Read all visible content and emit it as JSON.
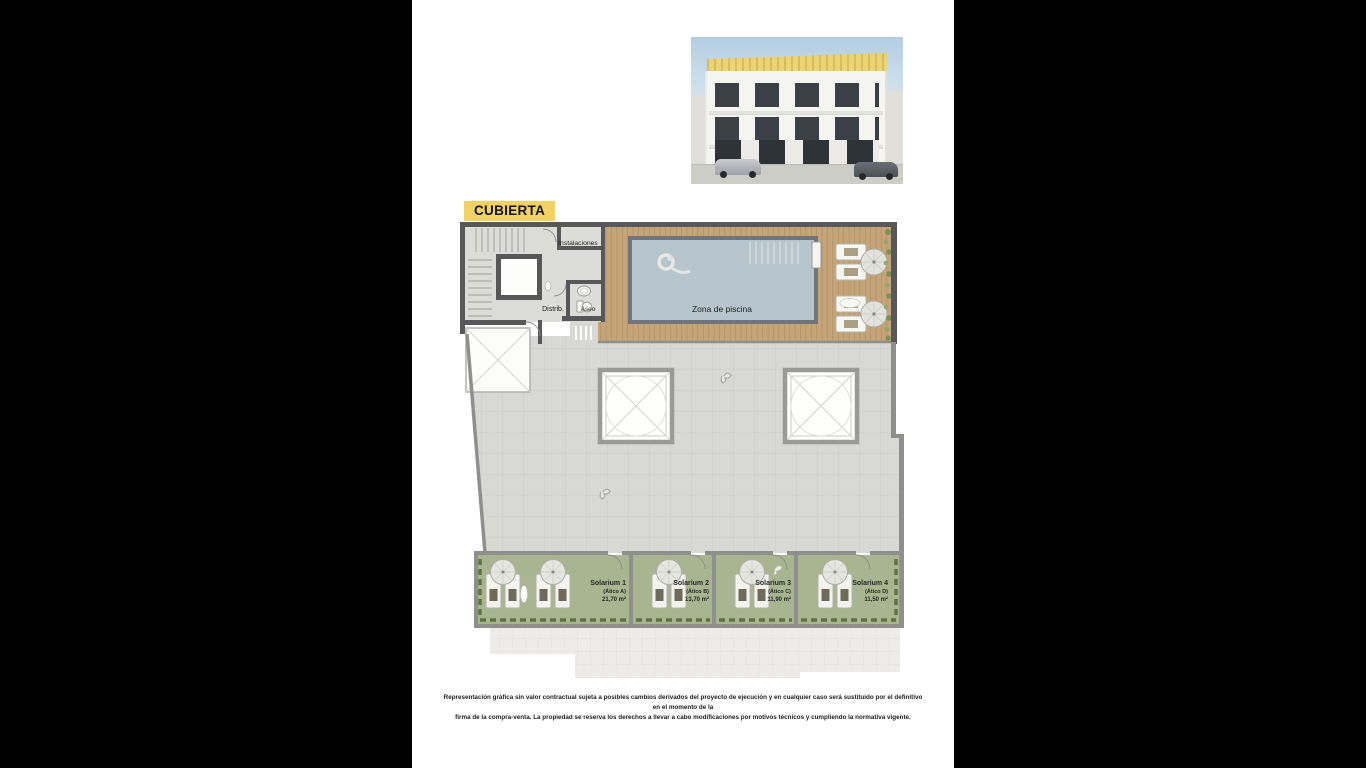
{
  "page": {
    "letterbox_color": "#000000",
    "paper_color": "#ffffff"
  },
  "header": {
    "plan_title": "CUBIERTA",
    "title_highlight": "#f2d265"
  },
  "elevation": {
    "description": "front elevation render of white 3-storey apartment building with highlighted roof level",
    "roof_highlight": "#f0d468"
  },
  "plan": {
    "rooms": {
      "instalaciones": "Instalaciones",
      "distribuidor": "Distrib.",
      "aseo": "Aseo",
      "zona_piscina": "Zona de piscina"
    },
    "solariums": [
      {
        "name": "Solarium 1",
        "unit": "(Ático A)",
        "area": "21,70 m²"
      },
      {
        "name": "Solarium 2",
        "unit": "(Ático B)",
        "area": "13,70 m²"
      },
      {
        "name": "Solarium 3",
        "unit": "(Ático C)",
        "area": "11,90 m²"
      },
      {
        "name": "Solarium 4",
        "unit": "(Ático D)",
        "area": "11,50 m²"
      }
    ],
    "colors": {
      "wall_dark": "#58585a",
      "wall_gray": "#8f8f8d",
      "terrace": "#d8d8d5",
      "deck_wood": "#c4a478",
      "pool_water": "#b6c6cc",
      "grass": "#a9b591"
    },
    "icons": [
      "swimmer-icon",
      "parasol-icon",
      "sun-lounger-icon",
      "stairs-icon",
      "elevator-icon",
      "skylight-icon",
      "wc-icon",
      "sink-icon",
      "plant-icon",
      "bird-icon",
      "pool-ladder-icon"
    ]
  },
  "footer": {
    "disclaimer_line1": "Representación gráfica sin valor contractual sujeta a posibles cambios derivados del proyecto de ejecución y en cualquier caso será sustituido por el definitivo en el momento de la",
    "disclaimer_line2": "firma de la compra-venta. La propiedad se reserva los derechos a llevar a cabo modificaciones por motivos técnicos y cumpliendo la normativa vigente."
  }
}
